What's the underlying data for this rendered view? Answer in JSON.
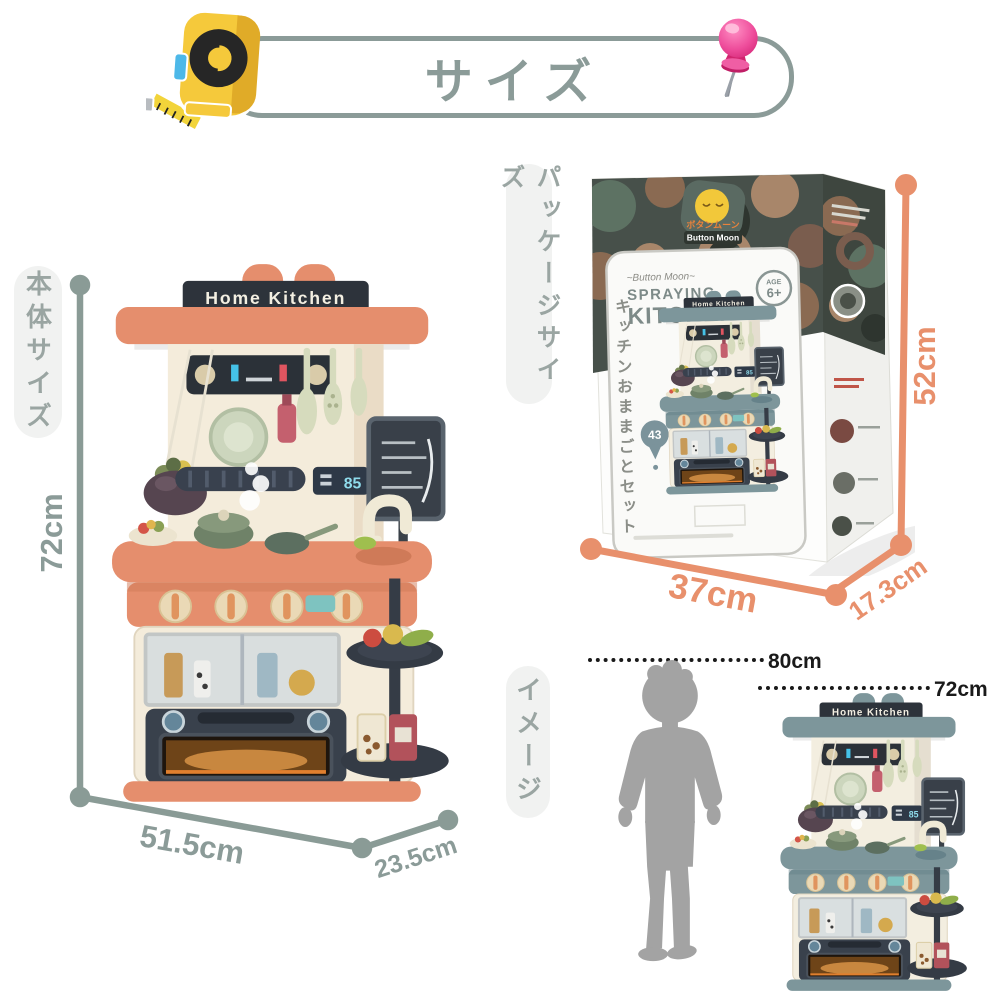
{
  "title": "サイズ",
  "body_size": {
    "label": "本体サイズ",
    "height": "72cm",
    "width": "51.5cm",
    "depth": "23.5cm"
  },
  "package_size": {
    "label": "パッケージサイズ",
    "height": "52cm",
    "width": "37cm",
    "depth": "17.3cm"
  },
  "image_section": {
    "label": "イメージ",
    "child_height": "80cm",
    "product_height": "72cm"
  },
  "kitchen": {
    "sign": "Home Kitchen",
    "timer": "85"
  },
  "box": {
    "brand_jp": "ボタンムーン",
    "brand": "Button Moon",
    "tagline": "~Button Moon~",
    "name_line1": "SPRAYING",
    "name_line2": "KITCHEN",
    "age_label": "AGE",
    "age_value": "6+",
    "jp_title": "キッチンおままごとセット",
    "pieces": "43"
  },
  "icons": {
    "title_left": "tape-measure-icon",
    "title_right": "push-pin-icon"
  },
  "colors": {
    "sage": "#8b9b98",
    "salmon": "#e8906c",
    "ink": "#1a1a1a",
    "pill_bg": "#f1f2f1",
    "pill_text": "#9aa5a2",
    "kitchen_orange": "#e58e6d",
    "kitchen_teal": "#7d969b",
    "silhouette": "#a3a3a3"
  }
}
